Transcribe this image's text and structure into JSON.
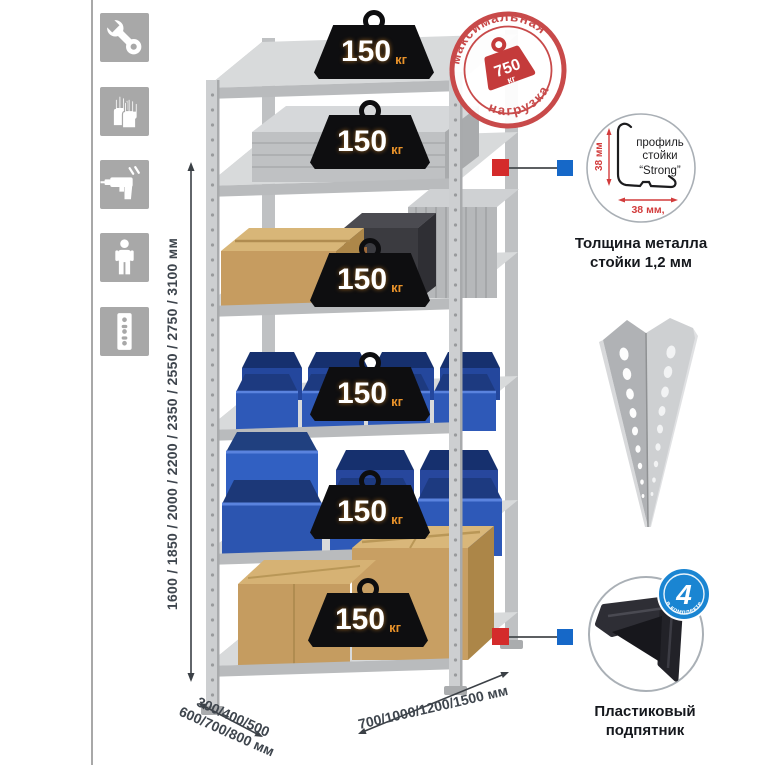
{
  "sidebar": {
    "icons": [
      {
        "name": "wrench"
      },
      {
        "name": "gloves"
      },
      {
        "name": "drill"
      },
      {
        "name": "person"
      },
      {
        "name": "perforated-strip"
      }
    ]
  },
  "dimensions": {
    "height": "1600 / 1850 / 2000 / 2200 / 2350 / 2550 / 2750 / 3100 мм",
    "depth_line1": "300/400/500",
    "depth_line2": "600/700/800 мм",
    "width": "700/1000/1200/1500 мм"
  },
  "rack": {
    "shelves": [
      {
        "load": "150",
        "unit": "кг"
      },
      {
        "load": "150",
        "unit": "кг"
      },
      {
        "load": "150",
        "unit": "кг"
      },
      {
        "load": "150",
        "unit": "кг"
      },
      {
        "load": "150",
        "unit": "кг"
      },
      {
        "load": "150",
        "unit": "кг"
      }
    ]
  },
  "stamp": {
    "arc_top": "максимальная",
    "arc_bottom": "нагрузка",
    "value": "750",
    "unit": "кг"
  },
  "profile_detail": {
    "dim_vertical": "38 мм",
    "dim_horizontal": "38 мм,",
    "label_line1": "профиль",
    "label_line2": "стойки",
    "label_line3": "“Strong”",
    "caption_line1": "Толщина металла",
    "caption_line2": "стойки 1,2 мм"
  },
  "foot_detail": {
    "badge_value": "4",
    "badge_text": "в комплекте",
    "caption_line1": "Пластиковый",
    "caption_line2": "подпятник"
  },
  "colors": {
    "stamp_red": "#c84a4a",
    "badge_blue": "#1a85d2",
    "connector_red": "#d42b2b",
    "connector_blue": "#1668c8",
    "bin_blue": "#2e59b8",
    "kg_orange": "#e8922a",
    "metal_gray": "#c9cbcd"
  }
}
